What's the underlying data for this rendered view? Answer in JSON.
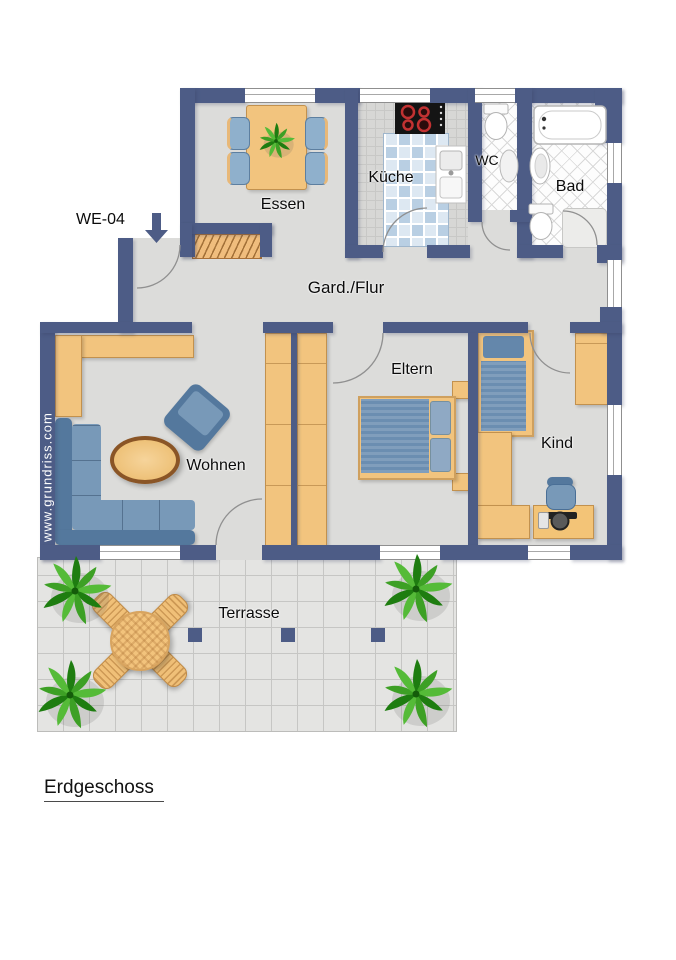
{
  "unit_label": "WE-04",
  "floor_label": "Erdgeschoss",
  "watermark": "www.grundriss.com",
  "rooms": {
    "dining": "Essen",
    "kitchen": "Küche",
    "wc": "WC",
    "bath": "Bad",
    "hall": "Gard./Flur",
    "living": "Wohnen",
    "parents": "Eltern",
    "child": "Kind",
    "terrace": "Terrasse"
  },
  "colors": {
    "wall": "#4d5c86",
    "floor": "#dcdcda",
    "wood": "#f2c47e",
    "upholstery_blue": "#6b8eb1",
    "kitchen_tile_blue": "#b9cfe3",
    "plant_green": "#2f8d1d",
    "terrace_floor": "#e4e4e2"
  }
}
